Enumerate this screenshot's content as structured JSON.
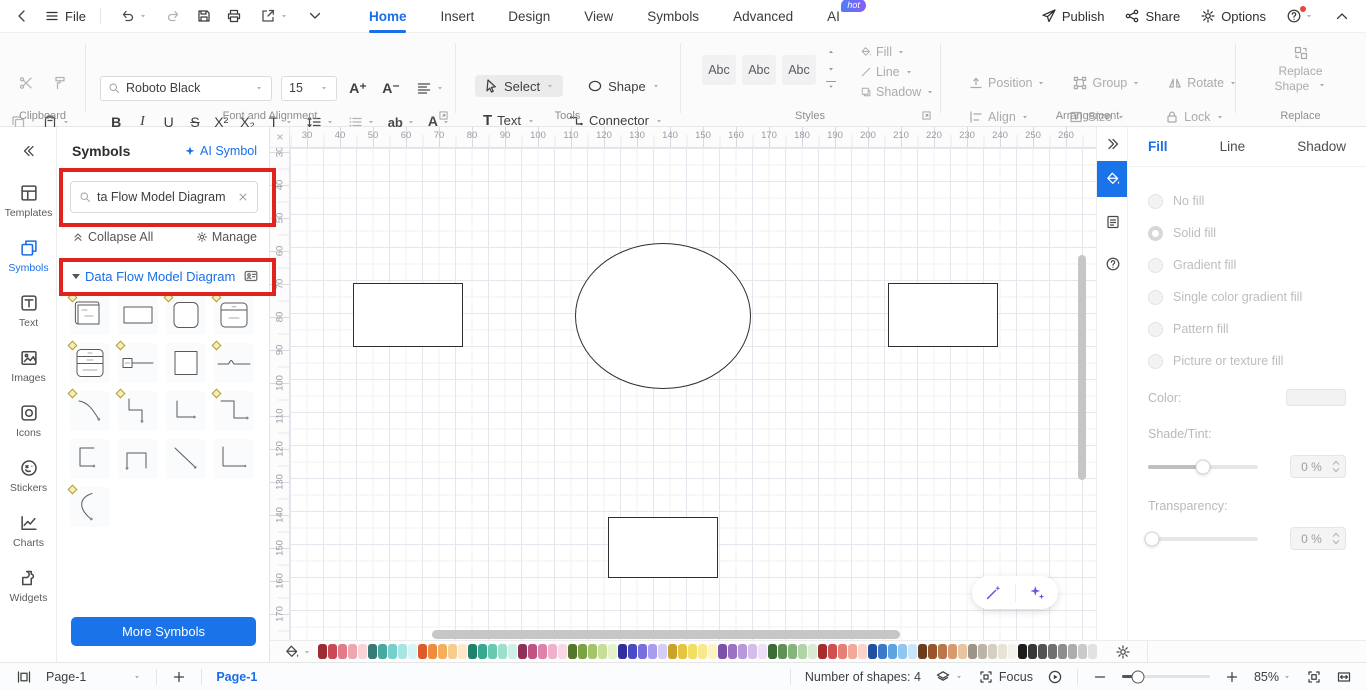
{
  "titlebar": {
    "file": "File",
    "tabs": [
      {
        "label": "Home",
        "active": true
      },
      {
        "label": "Insert"
      },
      {
        "label": "Design"
      },
      {
        "label": "View"
      },
      {
        "label": "Symbols"
      },
      {
        "label": "Advanced"
      },
      {
        "label": "AI",
        "badge": "hot"
      }
    ],
    "publish": "Publish",
    "share": "Share",
    "options": "Options"
  },
  "ribbon": {
    "clipboard_label": "Clipboard",
    "font": {
      "family": "Roboto Black",
      "size": "15",
      "section_label": "Font and Alignment",
      "bold": "B",
      "italic": "I",
      "underline": "U",
      "strike": "S",
      "superscript": "X²",
      "subscript": "X₂",
      "textfx": "T",
      "ab": "ab",
      "fontcolor": "A"
    },
    "tools": {
      "select": "Select",
      "shape": "Shape",
      "text": "Text",
      "connector": "Connector",
      "section_label": "Tools"
    },
    "styles": {
      "chips": [
        "Abc",
        "Abc",
        "Abc"
      ],
      "fill": "Fill",
      "line": "Line",
      "shadow": "Shadow",
      "section_label": "Styles"
    },
    "arrangement": {
      "position": "Position",
      "group": "Group",
      "rotate": "Rotate",
      "align": "Align",
      "size": "Size",
      "lock": "Lock",
      "section_label": "Arrangement"
    },
    "replace": {
      "button_line1": "Replace",
      "button_line2": "Shape",
      "section_label": "Replace"
    }
  },
  "sidebar": {
    "items": [
      {
        "label": "Templates",
        "icon": "templates"
      },
      {
        "label": "Symbols",
        "icon": "symbols-tool",
        "active": true
      },
      {
        "label": "Text",
        "icon": "text-tool"
      },
      {
        "label": "Images",
        "icon": "images"
      },
      {
        "label": "Icons",
        "icon": "icons-tool"
      },
      {
        "label": "Stickers",
        "icon": "stickers"
      },
      {
        "label": "Charts",
        "icon": "charts"
      },
      {
        "label": "Widgets",
        "icon": "widgets"
      }
    ]
  },
  "symbols_panel": {
    "title": "Symbols",
    "ai_symbol": "AI Symbol",
    "search_value": "ta Flow Model Diagram",
    "collapse_all": "Collapse All",
    "manage": "Manage",
    "section_title": "Data Flow Model Diagram",
    "more_button": "More Symbols",
    "grid": [
      {
        "shape": "process3d",
        "marker": true
      },
      {
        "shape": "rect",
        "marker": false
      },
      {
        "shape": "roundsq",
        "marker": true
      },
      {
        "shape": "entity1",
        "marker": true
      },
      {
        "shape": "entity2",
        "marker": true
      },
      {
        "shape": "tagline",
        "marker": true
      },
      {
        "shape": "square",
        "marker": false
      },
      {
        "shape": "wave",
        "marker": true
      },
      {
        "shape": "curve-arrow",
        "marker": true
      },
      {
        "shape": "elbow-arrow",
        "marker": true
      },
      {
        "shape": "l-arrow",
        "marker": false
      },
      {
        "shape": "z-arrow",
        "marker": true
      },
      {
        "shape": "c-arrow",
        "marker": false
      },
      {
        "shape": "u-arrow",
        "marker": false
      },
      {
        "shape": "diag-line",
        "marker": false
      },
      {
        "shape": "l-shape",
        "marker": false
      },
      {
        "shape": "arc",
        "marker": true
      }
    ]
  },
  "canvas": {
    "h_ruler": {
      "start": 30,
      "end": 260,
      "step": 10
    },
    "v_ruler": {
      "start": 30,
      "end": 170,
      "step": 10
    },
    "shapes": [
      {
        "type": "rect",
        "x": 83,
        "y": 156,
        "w": 110,
        "h": 64
      },
      {
        "type": "ellipse",
        "x": 305,
        "y": 116,
        "w": 176,
        "h": 146
      },
      {
        "type": "rect",
        "x": 618,
        "y": 156,
        "w": 110,
        "h": 64
      },
      {
        "type": "rect",
        "x": 338,
        "y": 390,
        "w": 110,
        "h": 61
      }
    ]
  },
  "right_panel": {
    "tabs": [
      {
        "label": "Fill",
        "active": true
      },
      {
        "label": "Line"
      },
      {
        "label": "Shadow"
      }
    ],
    "fill_options": [
      {
        "label": "No fill"
      },
      {
        "label": "Solid fill",
        "selected": true
      },
      {
        "label": "Gradient fill"
      },
      {
        "label": "Single color gradient fill"
      },
      {
        "label": "Pattern fill"
      },
      {
        "label": "Picture or texture fill"
      }
    ],
    "color_label": "Color:",
    "shade_label": "Shade/Tint:",
    "shade_value": "0 %",
    "shade_slider_pos": 50,
    "transparency_label": "Transparency:",
    "transparency_value": "0 %",
    "transparency_slider_pos": 0
  },
  "palette": {
    "colors": [
      "#9e2b33",
      "#c94a56",
      "#e27b87",
      "#efa6af",
      "#f8d3d8",
      "#387a78",
      "#48a8a4",
      "#74cfcd",
      "#a8e4e3",
      "#d8f3f3",
      "#df5a2a",
      "#ee8b3c",
      "#f4ae5e",
      "#f8cc8c",
      "#fce8c9",
      "#21816d",
      "#36a98e",
      "#67c9ae",
      "#9cdfcb",
      "#cef0e6",
      "#903058",
      "#c05381",
      "#dd82a9",
      "#eeb0cb",
      "#f8d8e7",
      "#55772b",
      "#7aa343",
      "#a3c468",
      "#c7de97",
      "#e5f1c8",
      "#30309c",
      "#4a4ac8",
      "#7a6ede",
      "#a89cee",
      "#d3cdf7",
      "#c9a22a",
      "#e6c53e",
      "#f3dd62",
      "#f9e98e",
      "#fcf4c3",
      "#7e51a8",
      "#9b72c3",
      "#b997da",
      "#d5bdea",
      "#ecdff7",
      "#3c6c36",
      "#5f9156",
      "#86b47d",
      "#b0d3a8",
      "#d8ebd3",
      "#a42e2e",
      "#cf5151",
      "#e87f74",
      "#f2a999",
      "#fad4ca",
      "#20509e",
      "#3b78c9",
      "#5ca4e0",
      "#8fc7ee",
      "#c9e5f8",
      "#6f3b20",
      "#97552d",
      "#b9774b",
      "#d59b6f",
      "#e9c4a1",
      "#9c9489",
      "#bcb4a7",
      "#d5cfc3",
      "#e7e3d9",
      "#f4f2eb",
      "#1c1c1c",
      "#373737",
      "#525252",
      "#6f6f6f",
      "#8d8d8d",
      "#acacac",
      "#cacaca",
      "#e2e2e2"
    ]
  },
  "statusbar": {
    "page_select": "Page-1",
    "page_tab": "Page-1",
    "shape_count": "Number of shapes: 4",
    "focus": "Focus",
    "zoom": "85%"
  },
  "annotation_color": "#e0231d"
}
